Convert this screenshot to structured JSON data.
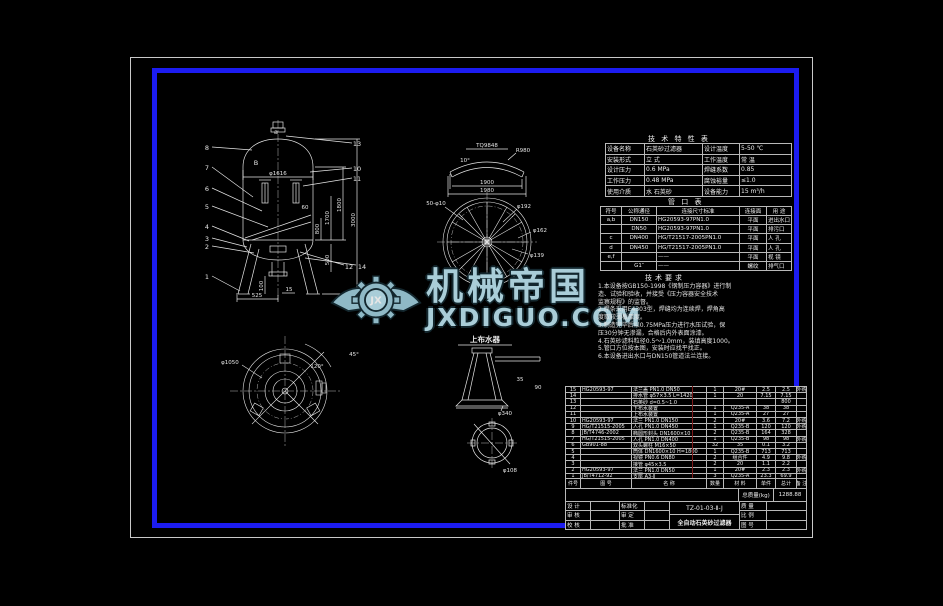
{
  "watermark": {
    "brand": "机械帝国",
    "site": "JXDIGUO.COM",
    "logo_monogram": "JX"
  },
  "colors": {
    "background": "#000000",
    "frame_blue": "#1c1cf0",
    "line": "#e8e8e8",
    "watermark_fill": "#a9cdd8",
    "watermark_outline": "#13272e",
    "red_mark": "#7c1a1a"
  },
  "tech_table": {
    "title": "技 术 特 性 表",
    "rows": [
      [
        "设备名称",
        "石英砂过滤器",
        "设计温度",
        "5-50 ℃"
      ],
      [
        "安装形式",
        "立  式",
        "工作温度",
        "常  温"
      ],
      [
        "设计压力",
        "0.6 MPa",
        "焊缝系数",
        "0.85"
      ],
      [
        "工作压力",
        "0.48 MPa",
        "腐蚀裕量",
        "≤1.0"
      ],
      [
        "使用介质",
        "水 石英砂",
        "设备能力",
        "15 m³/h"
      ]
    ]
  },
  "nozzle_table": {
    "title": "管  口  表",
    "headers": [
      "符号",
      "公称通径",
      "连接尺寸标准",
      "连接面",
      "用 途"
    ],
    "rows": [
      [
        "a,b",
        "DN150",
        "HG20593-97PN1.0",
        "平面",
        "进出水口"
      ],
      [
        "",
        "DN50",
        "HG20593-97PN1.0",
        "平面",
        "排污口"
      ],
      [
        "c",
        "DN400",
        "HG/T21517-2005PN1.0",
        "平面",
        "人 孔"
      ],
      [
        "d",
        "DN450",
        "HG/T21517-2005PN1.0",
        "平面",
        "人 孔"
      ],
      [
        "e,f",
        "",
        "——",
        "平面",
        "视 镜"
      ],
      [
        "",
        "G1″",
        "——",
        "螺纹",
        "排气口"
      ]
    ]
  },
  "notes": {
    "title": "技术要求",
    "lines": [
      "1.本设备按GB150-1998《钢制压力容器》进行制",
      "  造、试验和验收，并接受《压力容器安全技术",
      "  监察规程》的监督。",
      "2.焊条采用E4303型，焊缝均为连续焊，焊角高",
      "  度取较薄板厚度。",
      "3.制造完毕后以0.75MPa压力进行水压试验，保",
      "  压30分钟无渗漏，合格后内外表面涂漆。",
      "4.石英砂滤料粒径0.5～1.0mm，装填高度1000。",
      "5.管口方位按本图，安装时应找平找正。",
      "6.本设备进出水口与DN150管道法兰连接。"
    ]
  },
  "parts_list": {
    "headers": [
      "件号",
      "图 号",
      "名  称",
      "数量",
      "材 料",
      "单件",
      "总计",
      "备 注"
    ],
    "rows": [
      [
        "15",
        "HG20593-97",
        "法兰盖 PN1.0 DN50",
        "1",
        "20#",
        "2.5",
        "2.5",
        "外购"
      ],
      [
        "14",
        "",
        "排水管 φ57×3.5 L=1420",
        "1",
        "20",
        "7.15",
        "7.15",
        ""
      ],
      [
        "13",
        "",
        "石英砂 d=0.5~1.0",
        "",
        "",
        "",
        "800",
        ""
      ],
      [
        "12",
        "",
        "下布水装置",
        "1",
        "Q235-A",
        "38",
        "38",
        ""
      ],
      [
        "11",
        "",
        "上布水装置",
        "1",
        "Q235-A",
        "27",
        "27",
        ""
      ],
      [
        "10",
        "HG20593-97",
        "法兰 PN1.0 DN150",
        "2",
        "20#",
        "3.6",
        "7.2",
        "外购"
      ],
      [
        "9",
        "HG/T21515-2005",
        "人孔 PN1.0 DN450",
        "1",
        "Q235-B",
        "120",
        "120",
        "外购"
      ],
      [
        "8",
        "JB/T4746-2002",
        "椭圆形封头 DN1600×10",
        "2",
        "Q235-B",
        "164",
        "328",
        ""
      ],
      [
        "7",
        "HG/T21515-2005",
        "人孔 PN1.0 DN400",
        "1",
        "Q235-B",
        "98",
        "98",
        "外购"
      ],
      [
        "6",
        "GB901-88",
        "双头螺柱 M16×50",
        "32",
        "35",
        "0.1",
        "3.2",
        ""
      ],
      [
        "5",
        "",
        "筒体 DN1600×10 H=1800",
        "1",
        "Q235-B",
        "713",
        "713",
        ""
      ],
      [
        "4",
        "",
        "视镜 PN0.6 DN80",
        "2",
        "组合件",
        "4.9",
        "9.8",
        "外购"
      ],
      [
        "3",
        "",
        "接管 φ45×3.5",
        "2",
        "20",
        "1.1",
        "2.2",
        ""
      ],
      [
        "2",
        "HG20593-97",
        "法兰 PN1.0 DN50",
        "1",
        "20#",
        "2.3",
        "2.3",
        "外购"
      ],
      [
        "1",
        "JB/T4712-92",
        "支座 A3-Ⅱ",
        "3",
        "Q235-A",
        "23.3",
        "69.9",
        ""
      ]
    ]
  },
  "summary": {
    "total_label": "总质量(kg)",
    "total_value": "1288.88"
  },
  "title_block": {
    "drawing_no": "TZ-01-03-Ⅱ-J",
    "drawing_name": "全自动石英砂过滤器",
    "sign_labels": [
      "设 计",
      "审 核",
      "校 核"
    ],
    "approve_labels": [
      "标准化",
      "审 定",
      "批 准"
    ],
    "right_labels": [
      "质 量",
      "比 例",
      "图 号"
    ]
  },
  "views": {
    "front": {
      "dims": {
        "dia": "φ1616",
        "h_shell": "1800",
        "h_total": "3000",
        "h_mid": "1700",
        "h_800": "800",
        "d60": "60",
        "d500": "500",
        "d100": "100",
        "d525": "525",
        "d15": "15"
      },
      "leaders_left": [
        "8",
        "7",
        "6",
        "5",
        "4",
        "3",
        "2",
        "1"
      ],
      "leaders_right": [
        "13",
        "10",
        "11",
        "12",
        "14"
      ],
      "marks": {
        "b": "B",
        "a": "a"
      }
    },
    "plate": {
      "label": "TQ9848",
      "angle": "10°",
      "radius": "R980",
      "dim1": "1900",
      "dim2": "1980"
    },
    "flange_circle": {
      "holes": "50-φ10",
      "d1": "φ192",
      "d2": "φ162",
      "d3": "φ139"
    },
    "top_view": {
      "dia": "φ1050",
      "angle1": "120°",
      "angle2": "45°"
    },
    "distributor": {
      "label": "上布水器",
      "dim1": "35",
      "dim2": "90",
      "base": "φ340",
      "pipe": "φ108"
    }
  }
}
